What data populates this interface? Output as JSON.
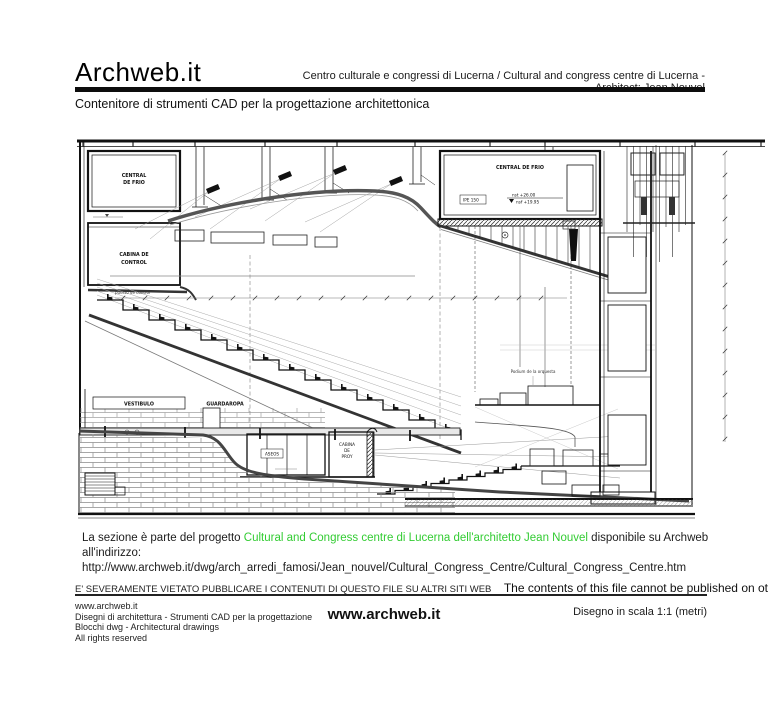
{
  "header": {
    "logo": "Archweb.it",
    "subtitle": "Centro culturale e congressi di Lucerna  /  Cultural and congress centre di Lucerna - Architect: Jean Nouvel",
    "tagline": "Contenitore di strumenti CAD per la progettazione architettonica"
  },
  "drawing": {
    "labels": {
      "plant_left_1": "CENTRAL",
      "plant_left_2": "DE FRIO",
      "control_1": "CABINA DE",
      "control_2": "CONTROL",
      "plant_right": "CENTRAL DE FRIO",
      "beam": "IPE 150",
      "level_top": "nst +26.00",
      "level_bottom": "nsf +19.95",
      "control_point": "puesto de control",
      "vestibule": "VESTIBULO",
      "wardrobe": "GUARDAROPA",
      "toilets": "ASEOS",
      "projection_1": "CABINA",
      "projection_2": "DE",
      "projection_3": "PROY",
      "podium": "Podium de la orquesta"
    }
  },
  "caption": {
    "text_before": "La sezione è parte del progetto",
    "highlight": "Cultural and Congress centre di Lucerna dell'architetto Jean Nouvel",
    "text_after": "disponibile su Archweb all'indirizzo:",
    "url": "http://www.archweb.it/dwg/arch_arredi_famosi/Jean_nouvel/Cultural_Congress_Centre/Cultural_Congress_Centre.htm",
    "highlight_color": "#33cc33"
  },
  "notice": {
    "italian": "E' SEVERAMENTE VIETATO PUBBLICARE I CONTENUTI DI QUESTO FILE SU ALTRI SITI WEB",
    "english": "The contents of this file cannot be published on other websites"
  },
  "footer": {
    "left_lines": [
      "www.archweb.it",
      "Disegni di architettura - Strumenti CAD  per la progettazione",
      "Blocchi dwg - Architectural drawings",
      "All rights reserved"
    ],
    "center": "www.archweb.it",
    "right": "Disegno in scala 1:1 (metri)"
  }
}
